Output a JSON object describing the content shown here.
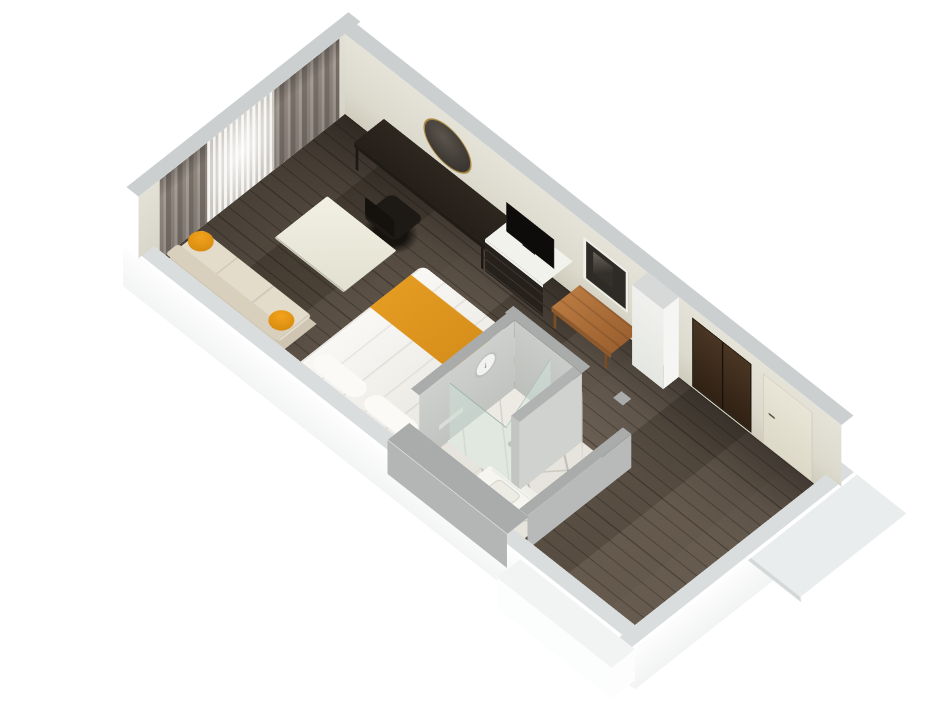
{
  "meta": {
    "type": "3d-floor-plan-render",
    "subject": "studio hotel room cutaway floor plan, axonometric view"
  },
  "palette": {
    "background": "#ffffff",
    "wall_outer": "#fbfcfc",
    "wall_cap": "#cbcfcf",
    "wall_cap_light": "#dadddd",
    "wall_inner": "#dfddd0",
    "pillar_face": "#eceee9",
    "floor_wood": "#675b4e",
    "bath_wall": "#c3c6c4",
    "bath_wall_low": "#b3b6b4",
    "bath_cap": "#a9acab",
    "marble": "#e7e4dd",
    "glass_tint": "#cde4da",
    "curtain_drape": "#8f867e",
    "curtain_sheer": "#eceae5",
    "bed_linen": "#f3f1eb",
    "accent_orange": "#e09a20",
    "sofa_base": "#cfc5b2",
    "sofa_cushion": "#e4dccb",
    "table_cream": "#ecebdd",
    "desk_dark": "#2a231c",
    "dresser_dark": "#27211b",
    "tv_black": "#0d0c0b",
    "bench_wood": "#b06f33",
    "wardrobe_wood": "#3a2a1c",
    "entry_door": "#e8e5d7",
    "bath_door": "#c9cbc7",
    "mirror_gold": "#a8873f"
  },
  "rooms": [
    {
      "name": "bedroom-living"
    },
    {
      "name": "bathroom"
    },
    {
      "name": "entry-hallway"
    }
  ],
  "objects": [
    {
      "name": "curtains",
      "area": "bedroom-living"
    },
    {
      "name": "sofa",
      "area": "bedroom-living"
    },
    {
      "name": "orange-pillows",
      "area": "bedroom-living"
    },
    {
      "name": "coffee-table",
      "area": "bedroom-living"
    },
    {
      "name": "bed",
      "area": "bedroom-living"
    },
    {
      "name": "bed-runner",
      "area": "bedroom-living"
    },
    {
      "name": "desk",
      "area": "bedroom-living"
    },
    {
      "name": "desk-chair",
      "area": "bedroom-living"
    },
    {
      "name": "round-wall-mirror",
      "area": "bedroom-living"
    },
    {
      "name": "dresser",
      "area": "bedroom-living"
    },
    {
      "name": "tv",
      "area": "bedroom-living"
    },
    {
      "name": "framed-art",
      "area": "bedroom-living"
    },
    {
      "name": "luggage-bench",
      "area": "bedroom-living"
    },
    {
      "name": "column",
      "area": "bedroom-living"
    },
    {
      "name": "shower",
      "area": "bathroom"
    },
    {
      "name": "shower-glass",
      "area": "bathroom"
    },
    {
      "name": "shower-head",
      "area": "bathroom"
    },
    {
      "name": "bathroom-door",
      "area": "bathroom"
    },
    {
      "name": "vanity",
      "area": "bathroom"
    },
    {
      "name": "bath-mat",
      "area": "bathroom"
    },
    {
      "name": "towel-bar",
      "area": "bathroom"
    },
    {
      "name": "wardrobe",
      "area": "entry-hallway"
    },
    {
      "name": "entry-door",
      "area": "entry-hallway"
    }
  ],
  "fixtures": {
    "shower_symbol": "↓"
  }
}
